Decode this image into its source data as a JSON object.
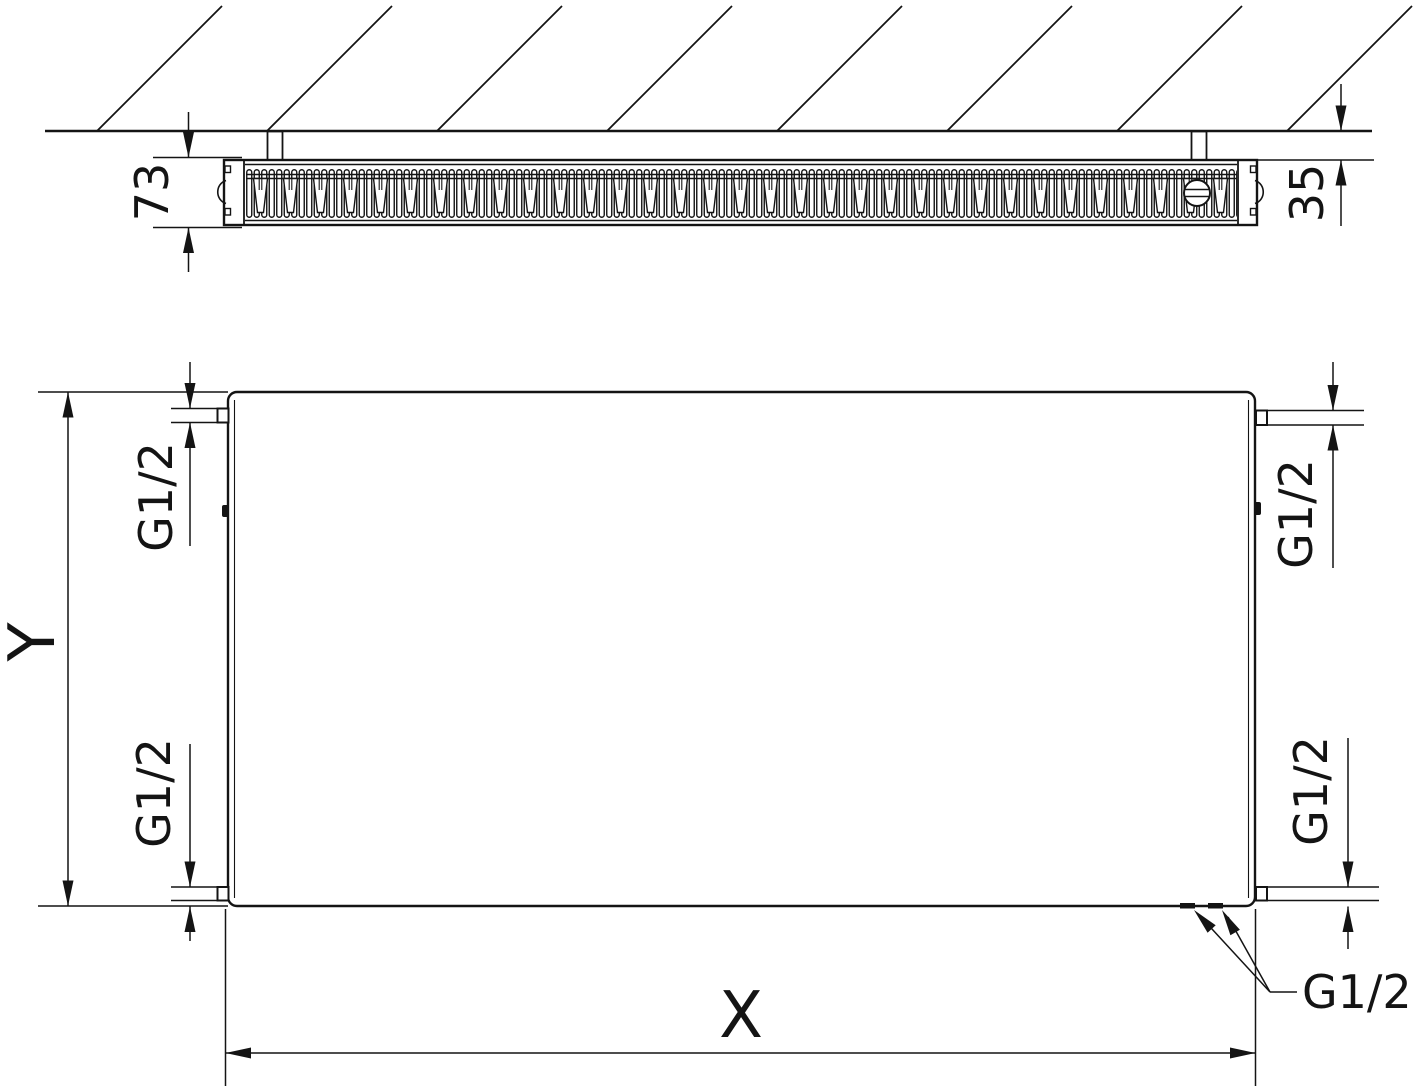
{
  "meta": {
    "drawing_type": "panel-radiator-dimension-drawing",
    "views": [
      "top-section-at-wall",
      "front-elevation"
    ]
  },
  "labels": {
    "depth": "73",
    "wall_distance": "35",
    "width": "X",
    "height": "Y",
    "thread_top_left": "G1/2",
    "thread_bottom_left": "G1/2",
    "thread_top_right": "G1/2",
    "thread_bottom_right": "G1/2",
    "thread_bottom_center": "G1/2"
  },
  "colors": {
    "line": "#141414",
    "background": "#ffffff"
  }
}
